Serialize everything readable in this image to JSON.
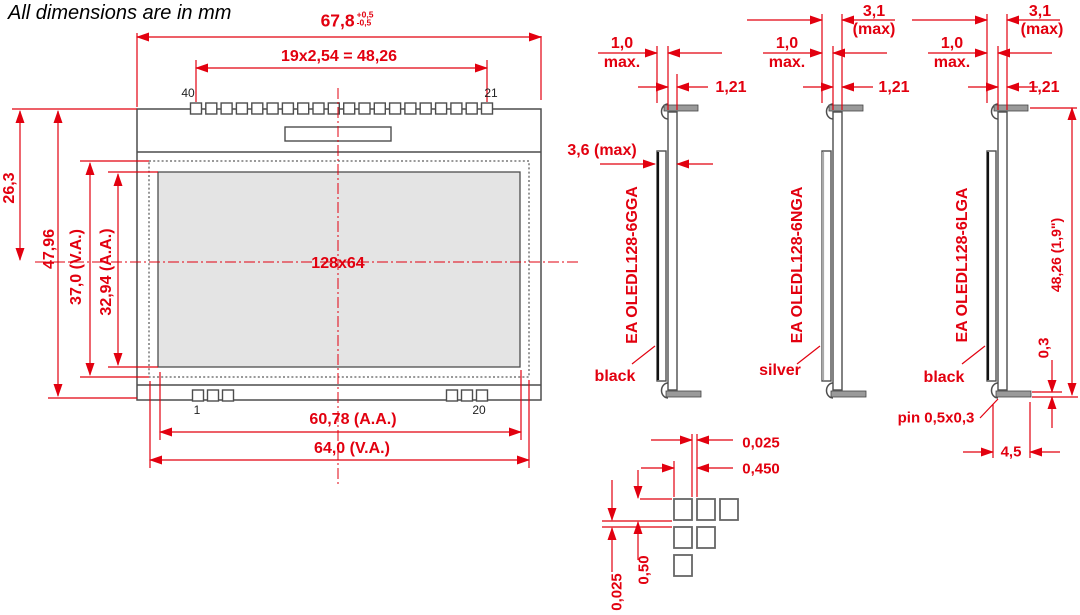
{
  "title": "All dimensions are in mm",
  "front": {
    "width_dim": {
      "value": "67,8",
      "tol_plus": "+0,5",
      "tol_minus": "-0,5"
    },
    "pitch_dim": "19x2,54 = 48,26",
    "pin_top_left": "40",
    "pin_top_right": "21",
    "pin_bottom_left": "1",
    "pin_bottom_right": "20",
    "height_to_center": "26,3",
    "height_total": "47,96",
    "height_va": "37,0 (V.A.)",
    "height_aa": "32,94 (A.A.)",
    "resolution": "128x64",
    "width_aa": "60,78 (A.A.)",
    "width_va": "64,0 (V.A.)"
  },
  "side_views": [
    {
      "name": "EA OLEDL128-6GGA",
      "bezel_color": "black",
      "thickness": "3,6 (max)",
      "pin_dim": "1,0",
      "pin_dim_qualifier": "max.",
      "offset_dim": "1,21"
    },
    {
      "name": "EA OLEDL128-6NGA",
      "bezel_color": "silver",
      "thickness": "3,1",
      "thickness_qualifier": "(max)",
      "pin_dim": "1,0",
      "pin_dim_qualifier": "max.",
      "offset_dim": "1,21"
    },
    {
      "name": "EA OLEDL128-6LGA",
      "bezel_color": "black",
      "thickness": "3,1",
      "thickness_qualifier": "(max)",
      "pin_dim": "1,0",
      "pin_dim_qualifier": "max.",
      "offset_dim": "1,21",
      "height_dim": "48,26 (1,9\")",
      "pin_thickness_dim": "0,3",
      "foot_dim": "4,5",
      "pin_note": "pin 0,5x0,3"
    }
  ],
  "pad_detail": {
    "gap_h": "0,025",
    "pitch_h": "0,450",
    "pad_v": "0,50",
    "gap_v": "0,025"
  },
  "colors": {
    "dimension_red": "#e2000f",
    "line_gray": "#4d4d4d",
    "active_area_fill": "#e4e4e4"
  }
}
